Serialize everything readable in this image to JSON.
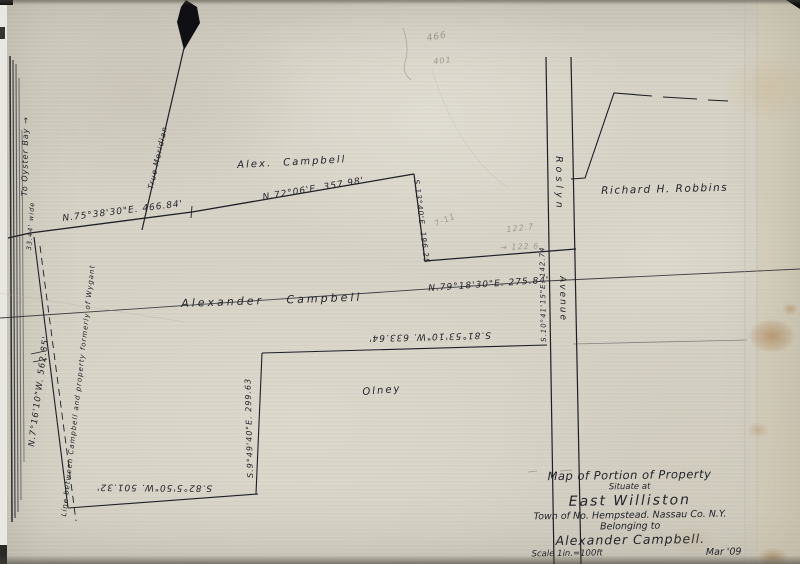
{
  "colors": {
    "ink": "#23232b",
    "pencil": "#8f8a7c",
    "paper": "#d6d2c6"
  },
  "parcels": {
    "north_owner": "Alex. Campbell",
    "main_owner": "Alexander Campbell",
    "south_owner": "Olney",
    "east_owner": "Richard H. Robbins"
  },
  "roads": {
    "avenue_top": "Roslyn",
    "avenue_bottom": "Avenue",
    "to_oyster_bay": "To Oyster Bay →",
    "width_note": "33.44' wide"
  },
  "bearings": {
    "top_west": "N.75°38'30\"E. 466.84'",
    "top_east": "N.72°06'E. 357.98'",
    "jog": "S.13°40'E. 196.25",
    "mid": "N.79°18'30\"E. 275.84'",
    "avenue": "S.10°41'15\"E. 142.74",
    "south_mid": "S.81°53'10\"W. 633.64'",
    "southeast": "S.9°49'40\"E. 299.63",
    "west": "N.7°16'10\"W. 562.85'",
    "south": "S.82°5'50\"W. 501.32'"
  },
  "notes": {
    "meridian": "True Meridian",
    "wygant": "Line between Campbell and property formerly of Wygant"
  },
  "pencil_marks": {
    "p466": "466",
    "p401": "401",
    "p711": "7-11",
    "p1227": "122.7",
    "p1226": "→ 122 6"
  },
  "title_block": {
    "line1": "Map of Portion of Property",
    "line2": "Situate at",
    "line3": "East Williston",
    "line4": "Town of No. Hempstead. Nassau Co. N.Y.",
    "line5": "Belonging to",
    "line6": "Alexander Campbell.",
    "scale": "Scale 1in.=100ft",
    "date": "Mar '09"
  }
}
